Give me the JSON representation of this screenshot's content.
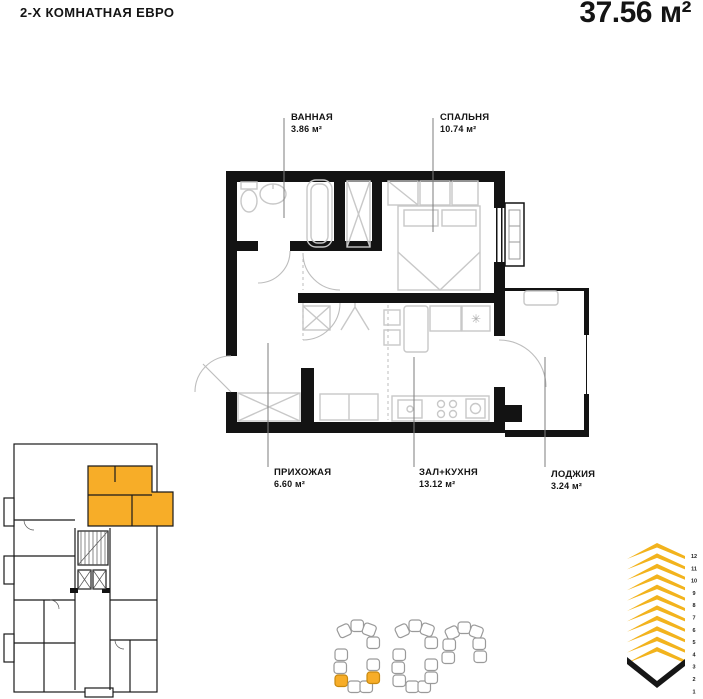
{
  "header": {
    "apartment_type": "2-Х КОМНАТНАЯ ЕВРО",
    "total_area": "37.56 м²"
  },
  "rooms": [
    {
      "name": "ВАННАЯ",
      "area": "3.86 м²"
    },
    {
      "name": "СПАЛЬНЯ",
      "area": "10.74 м²"
    },
    {
      "name": "ПРИХОЖАЯ",
      "area": "6.60 м²"
    },
    {
      "name": "ЗАЛ+КУХНЯ",
      "area": "13.12 м²"
    },
    {
      "name": "ЛОДЖИЯ",
      "area": "3.24 м²"
    }
  ],
  "icons": {
    "fridge_symbol": "✳"
  },
  "colors": {
    "accent_orange": "#F7AD28",
    "icon_yellow": "#F2B31D",
    "wall_black": "#131313",
    "furniture_gray": "#c8c8c8"
  },
  "site_plan": {
    "buildings": [
      {
        "id": "building-1",
        "blocks": [
          {
            "x": 338,
            "y": 625,
            "r": -25
          },
          {
            "x": 351,
            "y": 620
          },
          {
            "x": 363,
            "y": 624,
            "r": 20
          },
          {
            "x": 367,
            "y": 637
          },
          {
            "x": 335,
            "y": 649
          },
          {
            "x": 334,
            "y": 662
          },
          {
            "x": 367,
            "y": 659
          },
          {
            "x": 335,
            "y": 675,
            "hl": true
          },
          {
            "x": 348,
            "y": 681
          },
          {
            "x": 360,
            "y": 681
          },
          {
            "x": 367,
            "y": 672,
            "hl": true
          }
        ]
      },
      {
        "id": "building-2",
        "blocks": [
          {
            "x": 396,
            "y": 625,
            "r": -25
          },
          {
            "x": 409,
            "y": 620
          },
          {
            "x": 421,
            "y": 624,
            "r": 20
          },
          {
            "x": 425,
            "y": 637
          },
          {
            "x": 393,
            "y": 649
          },
          {
            "x": 392,
            "y": 662
          },
          {
            "x": 425,
            "y": 659
          },
          {
            "x": 393,
            "y": 675
          },
          {
            "x": 406,
            "y": 681
          },
          {
            "x": 418,
            "y": 681
          },
          {
            "x": 425,
            "y": 672
          }
        ]
      },
      {
        "id": "building-3",
        "blocks": [
          {
            "x": 446,
            "y": 627,
            "r": -25
          },
          {
            "x": 458,
            "y": 622
          },
          {
            "x": 470,
            "y": 626,
            "r": 20
          },
          {
            "x": 443,
            "y": 639
          },
          {
            "x": 442,
            "y": 652
          },
          {
            "x": 473,
            "y": 638
          },
          {
            "x": 474,
            "y": 651
          }
        ]
      }
    ]
  },
  "floor_selector": {
    "floors": [
      "12",
      "11",
      "10",
      "9",
      "8",
      "7",
      "6",
      "5",
      "4",
      "3",
      "2",
      "1"
    ],
    "selected_floor": "1"
  }
}
